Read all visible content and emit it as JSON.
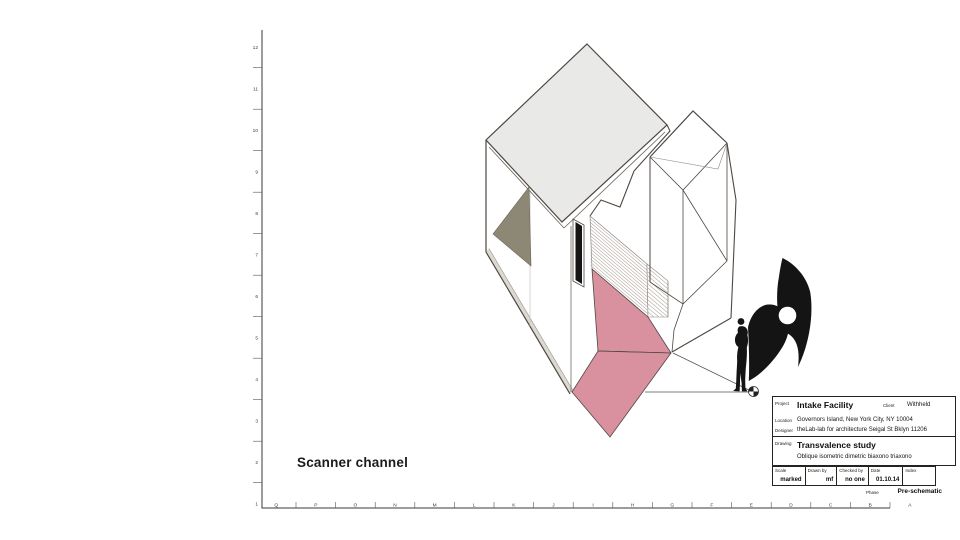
{
  "sheet": {
    "note": "Scanner channel",
    "grid_rows": [
      "12",
      "11",
      "10",
      "9",
      "8",
      "7",
      "6",
      "5",
      "4",
      "3",
      "2",
      "1"
    ],
    "grid_cols": [
      "Q",
      "P",
      "O",
      "N",
      "M",
      "L",
      "K",
      "J",
      "I",
      "H",
      "G",
      "F",
      "E",
      "D",
      "C",
      "B",
      "A"
    ],
    "title_block": {
      "project_label": "Project",
      "project": "Intake Facility",
      "client_label": "Client",
      "client": "Withheld",
      "location_label": "Location",
      "location": "Governors Island, New York City, NY 10004",
      "designer_label": "Designer",
      "designer": "theLab-lab for architecture  Seigal St  Bklyn  11206",
      "drawing_label": "Drawing",
      "drawing": "Transvalence study",
      "drawing_subtitle": "Oblique  isometric  dimetric  biaxono  triaxono",
      "scale_label": "Scale",
      "scale": "marked",
      "drawn_label": "Drawn by",
      "drawn": "mf",
      "checked_label": "Checked by",
      "checked": "no one",
      "date_label": "Date",
      "date": "01.10.14",
      "index_label": "Index",
      "index": "",
      "phase_label": "Phase",
      "phase": "Pre-schematic"
    },
    "colors": {
      "pink": "#d9909f",
      "roof": "#e9e9e8",
      "olive": "#8d8875",
      "plinth": "#dcd9d3",
      "ink": "#4f4741"
    }
  }
}
